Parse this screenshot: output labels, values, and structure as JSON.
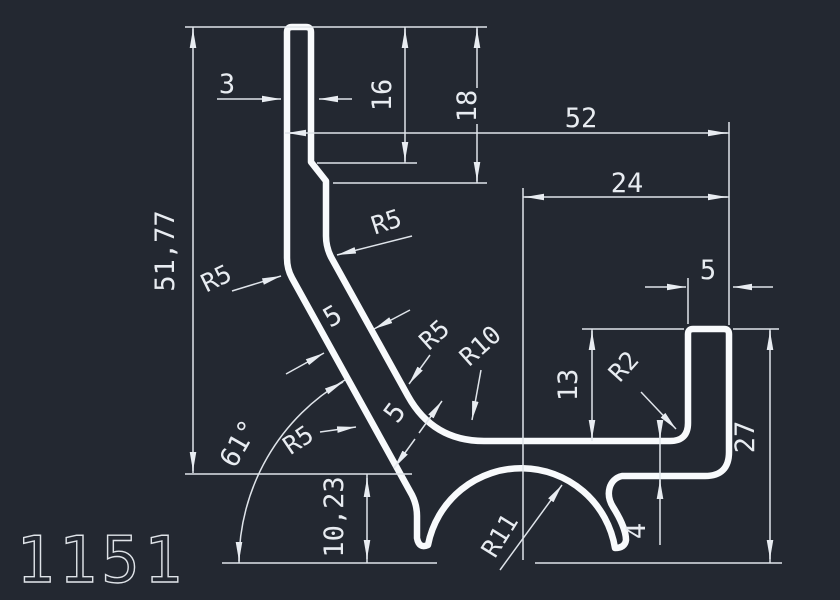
{
  "title": {
    "profile_number": "1151"
  },
  "colors": {
    "background": "#232831",
    "profile_line": "#f8fafc",
    "dimension_line": "#dfe4ea",
    "dimension_text": "#e8ecf1"
  },
  "dims": {
    "tongue_thickness": "3",
    "overall_width": "52",
    "channel_offset": "24",
    "wall_top_width": "5",
    "upper_inner_height": "16",
    "upper_outer_height": "18",
    "channel_depth": "13",
    "right_height": "27",
    "bottom_wall": "4",
    "wall_thickness_upper": "5",
    "wall_thickness_lower": "5",
    "total_height": "51,77",
    "foot_height": "10,23",
    "wall_angle": "61°"
  },
  "radii": {
    "r5_top": "R5",
    "r5_left": "R5",
    "r5_mid": "R5",
    "r5_low": "R5",
    "r10": "R10",
    "r11": "R11",
    "r2": "R2"
  }
}
